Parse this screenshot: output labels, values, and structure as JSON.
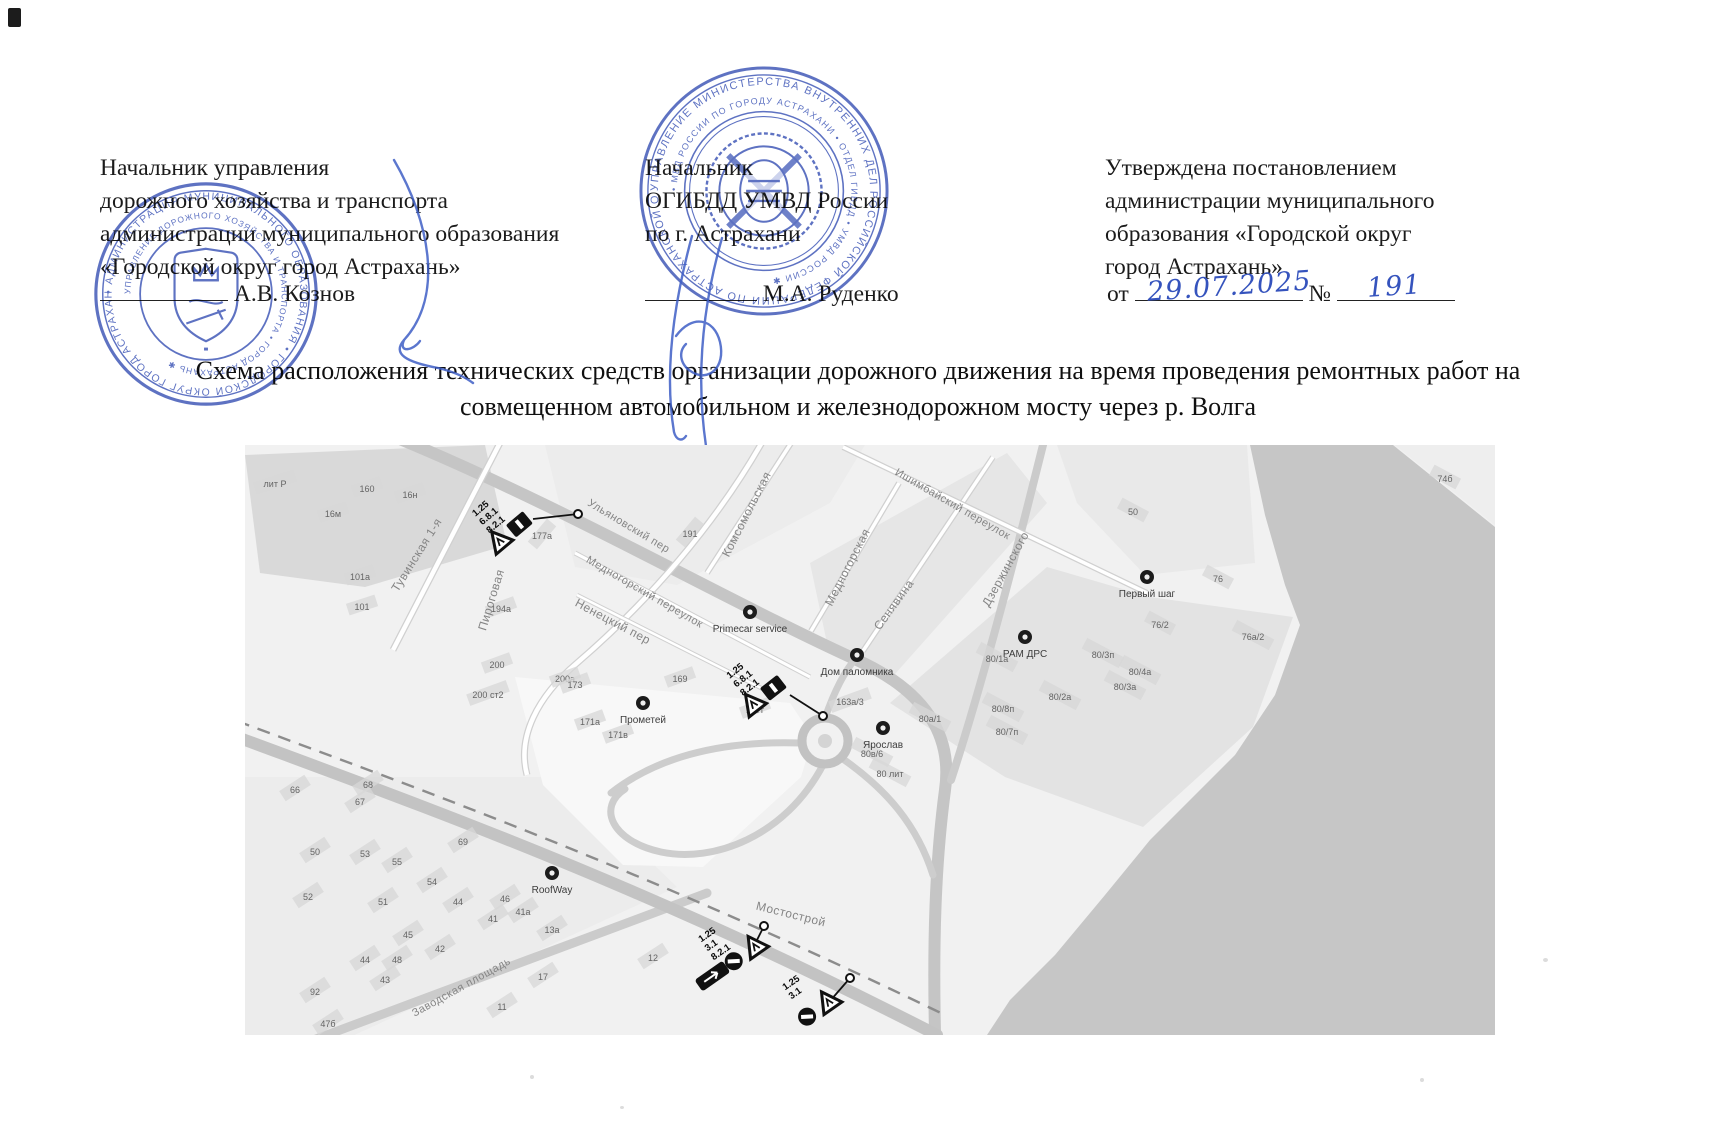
{
  "header": {
    "left": {
      "lines": [
        "Начальник управления",
        "дорожного хозяйства и транспорта",
        "администрации муниципального образования",
        "«Городской округ город Астрахань»"
      ],
      "name": "А.В. Кознов"
    },
    "center": {
      "lines": [
        "Начальник",
        "ОГИБДД УМВД России",
        "по г. Астрахани"
      ],
      "name": "М.А. Руденко"
    },
    "right": {
      "lines": [
        "Утверждена постановлением",
        "администрации муниципального",
        "образования «Городской округ",
        "город Астрахань»"
      ],
      "date_prefix": "от",
      "date_value": "29.07.2025",
      "number_label": "№",
      "number_value": "191"
    }
  },
  "title": {
    "line1": "Схема расположения технических средств организации дорожного движения на время проведения ремонтных работ на",
    "line2": "совмещенном автомобильном и железнодорожном мосту через р. Волга"
  },
  "stamps": {
    "left": {
      "outer_ring": "• АДМИНИСТРАЦИЯ МУНИЦИПАЛЬНОГО ОБРАЗОВАНИЯ • ГОРОДСКОЙ ОКРУГ ГОРОД АСТРАХАНЬ ",
      "inner_ring": "УПРАВЛЕНИЕ ДОРОЖНОГО ХОЗЯЙСТВА И ТРАНСПОРТА • ГОРОД АСТРАХАНЬ ✱ ",
      "color": "#3a53b5"
    },
    "right": {
      "outer_ring": "УПРАВЛЕНИЕ МИНИСТЕРСТВА ВНУТРЕННИХ ДЕЛ РОССИЙСКОЙ ФЕДЕРАЦИИ ПО АСТРАХАНСКОЙ ОБЛАСТИ ",
      "inner_ring": "• МВД РОССИИ ПО ГОРОДУ АСТРАХАНИ • ОТДЕЛ ГИБДД • УМВД РОССИИ ✱ ",
      "color": "#3a53b5"
    }
  },
  "map": {
    "streets": [
      {
        "name": "Тувинская 1-я",
        "x": 175,
        "y": 112,
        "r": -58
      },
      {
        "name": "Пироговая",
        "x": 250,
        "y": 156,
        "r": -73
      },
      {
        "name": "Ульяновский пер",
        "x": 382,
        "y": 84,
        "r": 31
      },
      {
        "name": "Медногорский переулок",
        "x": 398,
        "y": 150,
        "r": 30
      },
      {
        "name": "Ненецкий пер",
        "x": 366,
        "y": 180,
        "r": 28
      },
      {
        "name": "Комсомольская",
        "x": 505,
        "y": 71,
        "r": -63
      },
      {
        "name": "Медногорская",
        "x": 606,
        "y": 124,
        "r": -63
      },
      {
        "name": "Ишимбайский переулок",
        "x": 706,
        "y": 62,
        "r": 30
      },
      {
        "name": "Сенявина",
        "x": 652,
        "y": 162,
        "r": -54
      },
      {
        "name": "Дзержинского",
        "x": 764,
        "y": 126,
        "r": -61
      },
      {
        "name": "Заводская площадь",
        "x": 218,
        "y": 545,
        "r": -29
      },
      {
        "name": "Мостострой",
        "x": 545,
        "y": 473,
        "r": 14
      }
    ],
    "buildings": [
      {
        "t": "лит Р",
        "x": 30,
        "y": 42,
        "r": -18
      },
      {
        "t": "160",
        "x": 122,
        "y": 47,
        "r": -18
      },
      {
        "t": "16н",
        "x": 165,
        "y": 53,
        "r": -18
      },
      {
        "t": "16м",
        "x": 88,
        "y": 72,
        "r": -18
      },
      {
        "t": "101а",
        "x": 115,
        "y": 135,
        "r": -18
      },
      {
        "t": "101",
        "x": 117,
        "y": 165,
        "r": -18
      },
      {
        "t": "177а",
        "x": 297,
        "y": 94,
        "r": -50
      },
      {
        "t": "191",
        "x": 445,
        "y": 92,
        "r": -50
      },
      {
        "t": "194а",
        "x": 256,
        "y": 167,
        "r": -20
      },
      {
        "t": "200",
        "x": 252,
        "y": 223,
        "r": -20
      },
      {
        "t": "200а",
        "x": 320,
        "y": 237,
        "r": -20
      },
      {
        "t": "200 ст2",
        "x": 243,
        "y": 253,
        "r": -20
      },
      {
        "t": "169",
        "x": 435,
        "y": 237,
        "r": -20
      },
      {
        "t": "167г",
        "x": 510,
        "y": 268,
        "r": -20
      },
      {
        "t": "171а",
        "x": 345,
        "y": 280,
        "r": -20
      },
      {
        "t": "171в",
        "x": 373,
        "y": 293,
        "r": -20
      },
      {
        "t": "173",
        "x": 330,
        "y": 243,
        "r": -20
      },
      {
        "t": "163а/3",
        "x": 605,
        "y": 260,
        "r": -20
      },
      {
        "t": "50",
        "x": 888,
        "y": 70,
        "r": 28
      },
      {
        "t": "74б",
        "x": 1200,
        "y": 37,
        "r": 28
      },
      {
        "t": "76",
        "x": 973,
        "y": 137,
        "r": 28
      },
      {
        "t": "76/2",
        "x": 915,
        "y": 183,
        "r": 28
      },
      {
        "t": "76а/2",
        "x": 1008,
        "y": 195,
        "r": 28
      },
      {
        "t": "80/1а",
        "x": 752,
        "y": 217,
        "r": 28
      },
      {
        "t": "80/3п",
        "x": 858,
        "y": 213,
        "r": 28
      },
      {
        "t": "80а/1",
        "x": 685,
        "y": 277,
        "r": 28
      },
      {
        "t": "80в/6",
        "x": 627,
        "y": 312,
        "r": 28
      },
      {
        "t": "80 лит",
        "x": 645,
        "y": 332,
        "r": 28
      },
      {
        "t": "80/8п",
        "x": 758,
        "y": 267,
        "r": 28
      },
      {
        "t": "80/7п",
        "x": 762,
        "y": 290,
        "r": 28
      },
      {
        "t": "80/2а",
        "x": 815,
        "y": 255,
        "r": 28
      },
      {
        "t": "80/4а",
        "x": 895,
        "y": 230,
        "r": 28
      },
      {
        "t": "80/3а",
        "x": 880,
        "y": 245,
        "r": 28
      },
      {
        "t": "66",
        "x": 50,
        "y": 348,
        "r": -33
      },
      {
        "t": "68",
        "x": 123,
        "y": 343,
        "r": -33
      },
      {
        "t": "67",
        "x": 115,
        "y": 360,
        "r": -33
      },
      {
        "t": "69",
        "x": 218,
        "y": 400,
        "r": -33
      },
      {
        "t": "50",
        "x": 70,
        "y": 410,
        "r": -33
      },
      {
        "t": "53",
        "x": 120,
        "y": 412,
        "r": -33
      },
      {
        "t": "55",
        "x": 152,
        "y": 420,
        "r": -33
      },
      {
        "t": "54",
        "x": 187,
        "y": 440,
        "r": -33
      },
      {
        "t": "52",
        "x": 63,
        "y": 455,
        "r": -33
      },
      {
        "t": "51",
        "x": 138,
        "y": 460,
        "r": -33
      },
      {
        "t": "44",
        "x": 213,
        "y": 460,
        "r": -33
      },
      {
        "t": "46",
        "x": 260,
        "y": 457,
        "r": -33
      },
      {
        "t": "41",
        "x": 248,
        "y": 477,
        "r": -33
      },
      {
        "t": "41а",
        "x": 278,
        "y": 470,
        "r": -33
      },
      {
        "t": "13а",
        "x": 307,
        "y": 488,
        "r": -33
      },
      {
        "t": "45",
        "x": 163,
        "y": 493,
        "r": -33
      },
      {
        "t": "42",
        "x": 195,
        "y": 507,
        "r": -33
      },
      {
        "t": "44",
        "x": 120,
        "y": 518,
        "r": -33
      },
      {
        "t": "48",
        "x": 152,
        "y": 518,
        "r": -33
      },
      {
        "t": "43",
        "x": 140,
        "y": 538,
        "r": -33
      },
      {
        "t": "92",
        "x": 70,
        "y": 550,
        "r": -33
      },
      {
        "t": "47б",
        "x": 83,
        "y": 582,
        "r": -33
      },
      {
        "t": "17",
        "x": 298,
        "y": 535,
        "r": -33
      },
      {
        "t": "11",
        "x": 257,
        "y": 565,
        "r": -33
      },
      {
        "t": "12",
        "x": 408,
        "y": 516,
        "r": -33
      }
    ],
    "pois": [
      {
        "name": "Primecar service",
        "x": 505,
        "y": 167
      },
      {
        "name": "Дом паломника",
        "x": 612,
        "y": 210
      },
      {
        "name": "РАМ ДРС",
        "x": 780,
        "y": 192
      },
      {
        "name": "Первый шаг",
        "x": 902,
        "y": 132
      },
      {
        "name": "Прометей",
        "x": 398,
        "y": 258
      },
      {
        "name": "Ярослав",
        "x": 638,
        "y": 283
      },
      {
        "name": "RoofWay",
        "x": 307,
        "y": 428
      }
    ],
    "signs": [
      {
        "labels": [
          "1.25",
          "6.8.1",
          "8.2.1"
        ],
        "x": 258,
        "y": 80,
        "rot": -40,
        "icons": [
          "triangle",
          "plate"
        ],
        "leader": [
          [
            288,
            74
          ],
          [
            333,
            69
          ]
        ]
      },
      {
        "labels": [
          "1.25",
          "6.8.1",
          "8.2.1"
        ],
        "x": 512,
        "y": 243,
        "rot": -38,
        "icons": [
          "triangle",
          "plate"
        ],
        "leader": [
          [
            545,
            250
          ],
          [
            578,
            271
          ]
        ]
      },
      {
        "labels": [
          "1.25",
          "3.1",
          "8.2.1"
        ],
        "x": 483,
        "y": 508,
        "rot": -35,
        "icons": [
          "bigplate",
          "noentry",
          "triangle"
        ],
        "leader": [
          [
            512,
            495
          ],
          [
            519,
            481
          ]
        ]
      },
      {
        "labels": [
          "1.25",
          "3.1"
        ],
        "x": 567,
        "y": 556,
        "rot": -35,
        "icons": [
          "noentry",
          "triangle"
        ],
        "leader": [
          [
            585,
            556
          ],
          [
            605,
            533
          ]
        ]
      }
    ]
  }
}
